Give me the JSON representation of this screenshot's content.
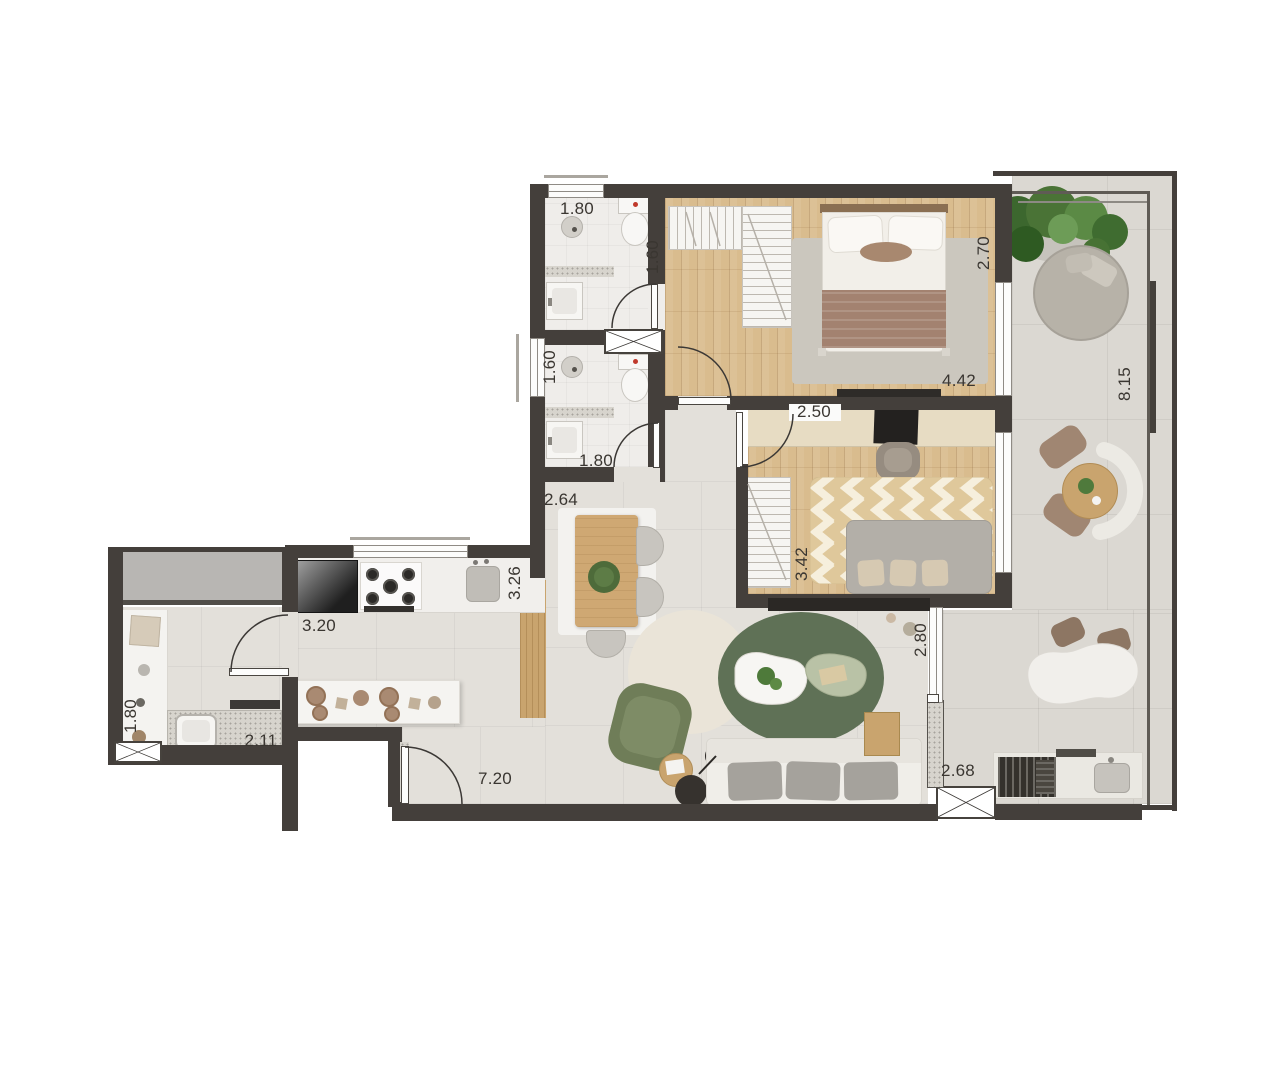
{
  "plan": {
    "colors": {
      "wall": "#443f3b",
      "tile": "#e3e0da",
      "balcony_tile": "#dbd8d2",
      "bath_tile": "#efedea",
      "wood_floor": "#d9bc8e",
      "wood_furniture": "#c9a46e",
      "gray_block": "#b8b6b3",
      "green_rug": "#5f7156",
      "armchair_green": "#6f7d58",
      "plant_green": "#4a7336",
      "label_ink": "#3a3631"
    },
    "dimension_labels": [
      {
        "id": "bath1-width",
        "text": "1.80",
        "x": 577,
        "y": 209,
        "rot": 0
      },
      {
        "id": "bath1-depth",
        "text": "1.60",
        "x": 653,
        "y": 257,
        "rot": -90
      },
      {
        "id": "bath2-depth",
        "text": "1.60",
        "x": 550,
        "y": 367,
        "rot": -90
      },
      {
        "id": "bath2-width",
        "text": "1.80",
        "x": 596,
        "y": 461,
        "rot": 0
      },
      {
        "id": "bedroom1-depth",
        "text": "2.70",
        "x": 984,
        "y": 253,
        "rot": -90
      },
      {
        "id": "bedroom1-width",
        "text": "4.42",
        "x": 959,
        "y": 381,
        "rot": 0
      },
      {
        "id": "balcony-length",
        "text": "8.15",
        "x": 1125,
        "y": 384,
        "rot": -90
      },
      {
        "id": "bedroom2-width",
        "text": "2.50",
        "x": 814,
        "y": 412,
        "rot": 0
      },
      {
        "id": "bedroom2-depth",
        "text": "3.42",
        "x": 802,
        "y": 564,
        "rot": -90
      },
      {
        "id": "living-width",
        "text": "2.80",
        "x": 921,
        "y": 640,
        "rot": -90
      },
      {
        "id": "dining-width",
        "text": "2.64",
        "x": 561,
        "y": 500,
        "rot": 0
      },
      {
        "id": "kitchen-width",
        "text": "3.20",
        "x": 319,
        "y": 626,
        "rot": 0
      },
      {
        "id": "kitchen-depth",
        "text": "3.26",
        "x": 515,
        "y": 583,
        "rot": -90
      },
      {
        "id": "laundry-depth",
        "text": "1.80",
        "x": 131,
        "y": 716,
        "rot": -90
      },
      {
        "id": "laundry-width",
        "text": "2.11",
        "x": 261,
        "y": 741,
        "rot": 0
      },
      {
        "id": "living-length",
        "text": "7.20",
        "x": 495,
        "y": 779,
        "rot": 0
      },
      {
        "id": "terrace-width",
        "text": "2.68",
        "x": 958,
        "y": 771,
        "rot": 0
      }
    ]
  }
}
